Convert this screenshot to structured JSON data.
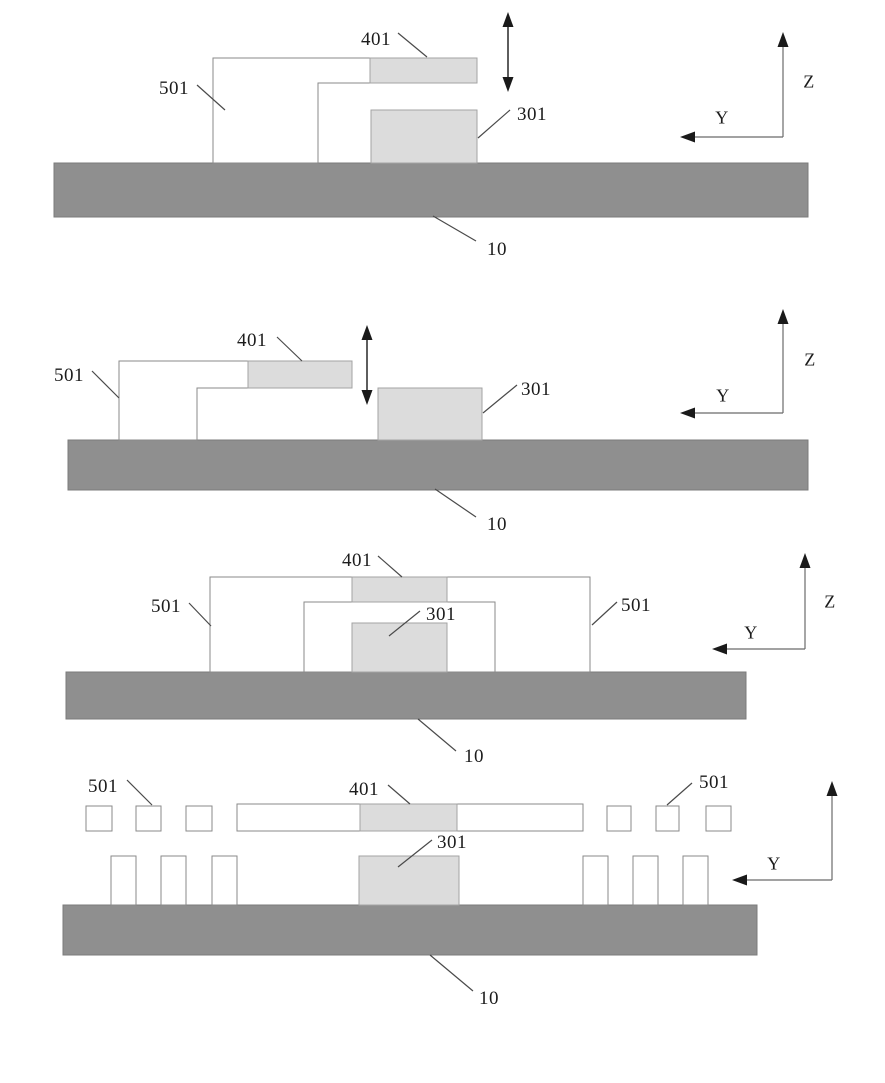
{
  "figure": {
    "description": "Four stacked cross-section schematic panels of a layered device",
    "colors": {
      "background": "#ffffff",
      "substrate_fill": "#8f8f8f",
      "substrate_border": "#7b7b7b",
      "block_fill": "#dcdcdc",
      "block_border": "#a3a3a3",
      "outline_stroke": "#8a8a8a",
      "leader_line": "#4a4a4a",
      "arrow_black": "#1a1a1a",
      "text": "#1c1c1c"
    }
  },
  "labels": {
    "p1": {
      "n401": "401",
      "n501": "501",
      "n301": "301",
      "n10": "10",
      "z": "Z",
      "y": "Y"
    },
    "p2": {
      "n401": "401",
      "n501": "501",
      "n301": "301",
      "n10": "10",
      "z": "Z",
      "y": "Y"
    },
    "p3": {
      "n401": "401",
      "n501l": "501",
      "n501r": "501",
      "n301": "301",
      "n10": "10",
      "z": "Z",
      "y": "Y"
    },
    "p4": {
      "n501l": "501",
      "n401": "401",
      "n501r": "501",
      "n301": "301",
      "n10": "10",
      "y": "Y"
    }
  }
}
